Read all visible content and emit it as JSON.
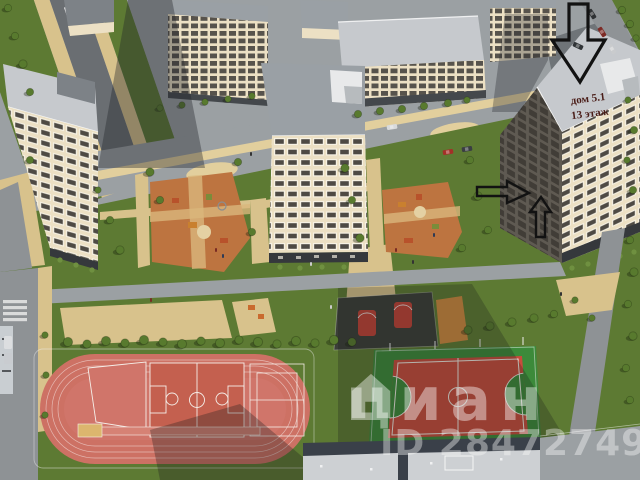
{
  "annotations": {
    "building_label": {
      "line1": "дом 5.1",
      "line2": "13 этаж"
    },
    "arrow_icons": [
      "arrow-down-icon",
      "arrow-right-icon",
      "arrow-up-icon"
    ]
  },
  "watermark": {
    "brand_text": "циан",
    "id_text": "ID 284727496",
    "icon": "house-icon"
  },
  "palette": {
    "lawn": "#5d7a33",
    "lawnDark": "#3f5a26",
    "road": "#9ba0a3",
    "asphalt": "#8e9295",
    "path": "#d8c28c",
    "pathLight": "#e2cf9d",
    "track": "#cd7164",
    "trackCourt": "#c4604f",
    "sand": "#dcb66e",
    "futsalGreen": "#3c8a3a",
    "futsalRed": "#c84b3c",
    "playground": "#bd7440",
    "streetball": "#3b3e38",
    "wall": "#ece0c4",
    "wallShade": "#5f5a52",
    "roofLight": "#c6c9cd",
    "roofMid": "#9aa0a5",
    "window": "#4e4a44",
    "tree": "#587a2e",
    "treeDark": "#3f5a26",
    "shadow": "rgba(30,32,30,0.32)",
    "annotation": "#121212",
    "labelColor": "#4a1d18",
    "watermark": "rgba(255,255,255,0.42)",
    "watermarkId": "rgba(250,250,250,0.40)"
  }
}
